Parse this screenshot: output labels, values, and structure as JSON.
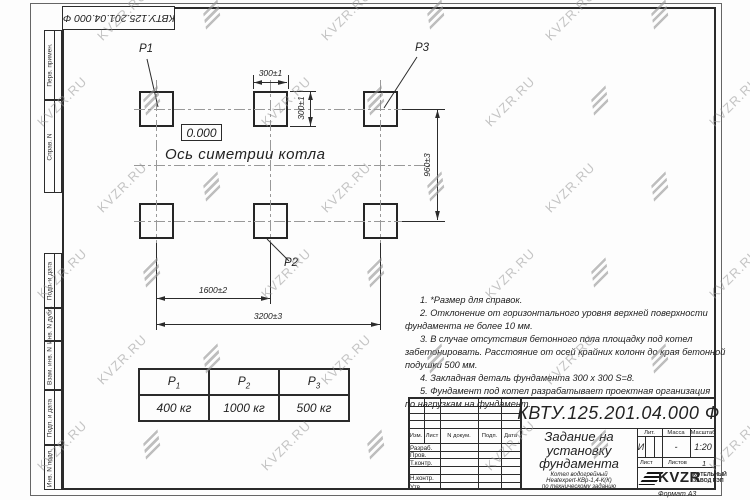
{
  "watermark": {
    "text": "KVZR.RU"
  },
  "corner_stamp": {
    "docnum": "КВТУ.125.201.04.000  Ф"
  },
  "margin_strips": {
    "s1": "Перв. примен.",
    "s2": "Справ. N",
    "s3": "Подп. и дата",
    "s4": "Инв. N дубл.",
    "s5": "Взам. инв. N",
    "s6": "Подп. и дата",
    "s7": "Инв. N подл."
  },
  "plan": {
    "pad_labels": {
      "p1": "P1",
      "p2": "P2",
      "p3": "P3"
    },
    "level_mark": "0.000",
    "axis_label": "Ось симетрии котла",
    "dimensions": {
      "pad_width": "300±1",
      "pad_height": "300±1",
      "row_pitch": "960±3",
      "col_pitch": "1600±2",
      "total": "3200±3"
    }
  },
  "notes": [
    [
      "1.  *Размер для справок."
    ],
    [
      "2.  Отклонение от горизонтального уровня верхней поверхности",
      "фундамента не более  10  мм."
    ],
    [
      "3.  В случае отсутствия бетонного пола площадку под котел",
      "забетонировать.  Расстояние от осей крайних колонн до края бетонной",
      "подушки  500  мм."
    ],
    [
      "4.  Закладная деталь фундамента   300 х 300  S=8."
    ],
    [
      "5.  Фундамент под котел разрабатывает проектная организация",
      "по нагрузкам на фундамент."
    ]
  ],
  "load_table": {
    "headers": [
      {
        "base": "P",
        "sub": "1"
      },
      {
        "base": "P",
        "sub": "2"
      },
      {
        "base": "P",
        "sub": "3"
      }
    ],
    "values": [
      "400  кг",
      "1000  кг",
      "500  кг"
    ]
  },
  "title_block": {
    "docnum": "КВТУ.125.201.04.000  Ф",
    "title_lines": [
      "Задание на",
      "установку",
      "фундамента"
    ],
    "subtitle_lines": [
      "Котел водогрейный",
      "Heatexpert-КВр-1,4-К(К)",
      "по техническому заданию"
    ],
    "header_cols": [
      "Изм.",
      "Лист",
      "N докум.",
      "Подп.",
      "Дата"
    ],
    "row_labels": [
      "Разраб.",
      "Пров.",
      "Т.контр.",
      "Н.контр.",
      "Утв."
    ],
    "lit_header": "Лит.",
    "mass_header": "Масса",
    "scale_header": "Масштаб",
    "lit_value": "И",
    "mass_value": "-",
    "scale_value": "1:20",
    "sheet_label": "Лист",
    "sheets_label": "Листов",
    "sheets_value": "1",
    "logo_text": "KVZR",
    "logo_caption_lines": [
      "КОТЕЛЬНЫЙ",
      "ЗАВОД РЭП"
    ]
  },
  "format_label": "Формат А3"
}
